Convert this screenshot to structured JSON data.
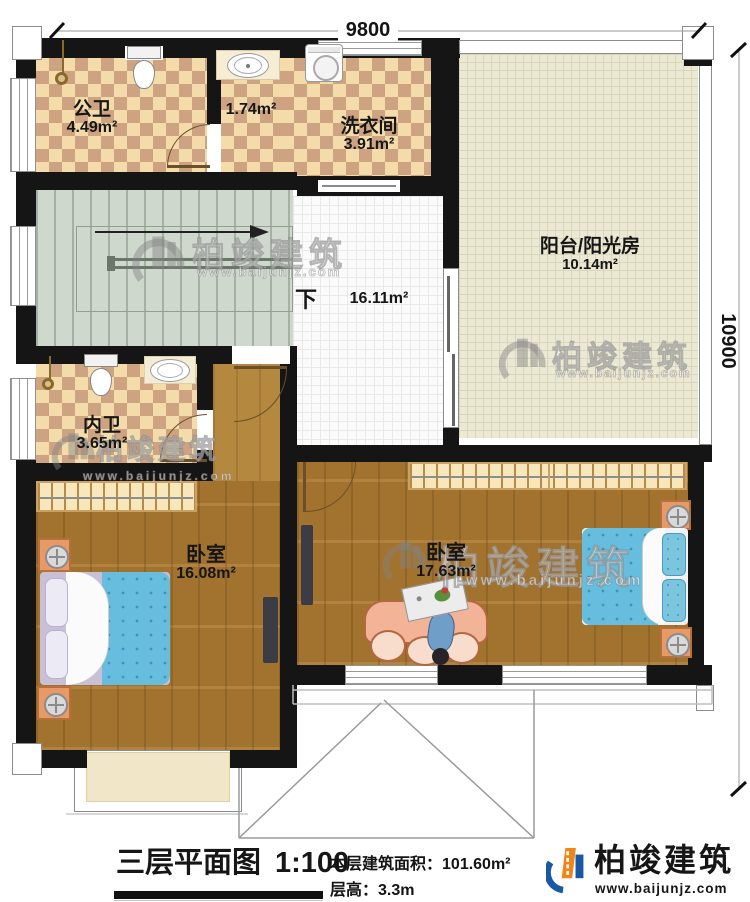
{
  "dimensions": {
    "width_label": "9800",
    "height_label": "10900"
  },
  "rooms": [
    {
      "id": "public-bathroom",
      "name": "公卫",
      "area": "4.49m²"
    },
    {
      "id": "wash-lobby",
      "name": "",
      "area": "1.74m²"
    },
    {
      "id": "laundry-room",
      "name": "洗衣间",
      "area": "3.91m²"
    },
    {
      "id": "balcony-sunroom",
      "name": "阳台/阳光房",
      "area": "10.14m²"
    },
    {
      "id": "hallway",
      "name": "",
      "area": "16.11m²"
    },
    {
      "id": "ensuite-bathroom",
      "name": "内卫",
      "area": "3.65m²"
    },
    {
      "id": "bedroom-left",
      "name": "卧室",
      "area": "16.08m²"
    },
    {
      "id": "bedroom-right",
      "name": "卧室",
      "area": "17.63m²"
    }
  ],
  "stairs": {
    "down_label": "下"
  },
  "title": {
    "plan_name": "三层平面图",
    "scale": "1:100",
    "area_label": "本层建筑面积：",
    "area_value": "101.60m²",
    "floor_height_label": "层高：",
    "floor_height_value": "3.3m"
  },
  "brand": {
    "name": "柏竣建筑",
    "website": "www.baijunjz.com"
  },
  "watermark": {
    "name": "柏竣建筑",
    "website": "www.baijunjz.com"
  },
  "colors": {
    "wall": "#151515",
    "checker_light": "#f3dcaa",
    "checker_dark": "#cda381",
    "wood": "#ab7931",
    "stair_green": "#ced8cc",
    "balcony_beige": "#ebe8d3",
    "bed_blue": "#66bddd",
    "sofa_peach": "#f2b396",
    "brand_blue": "#1b57a5",
    "brand_orange": "#f08519"
  }
}
